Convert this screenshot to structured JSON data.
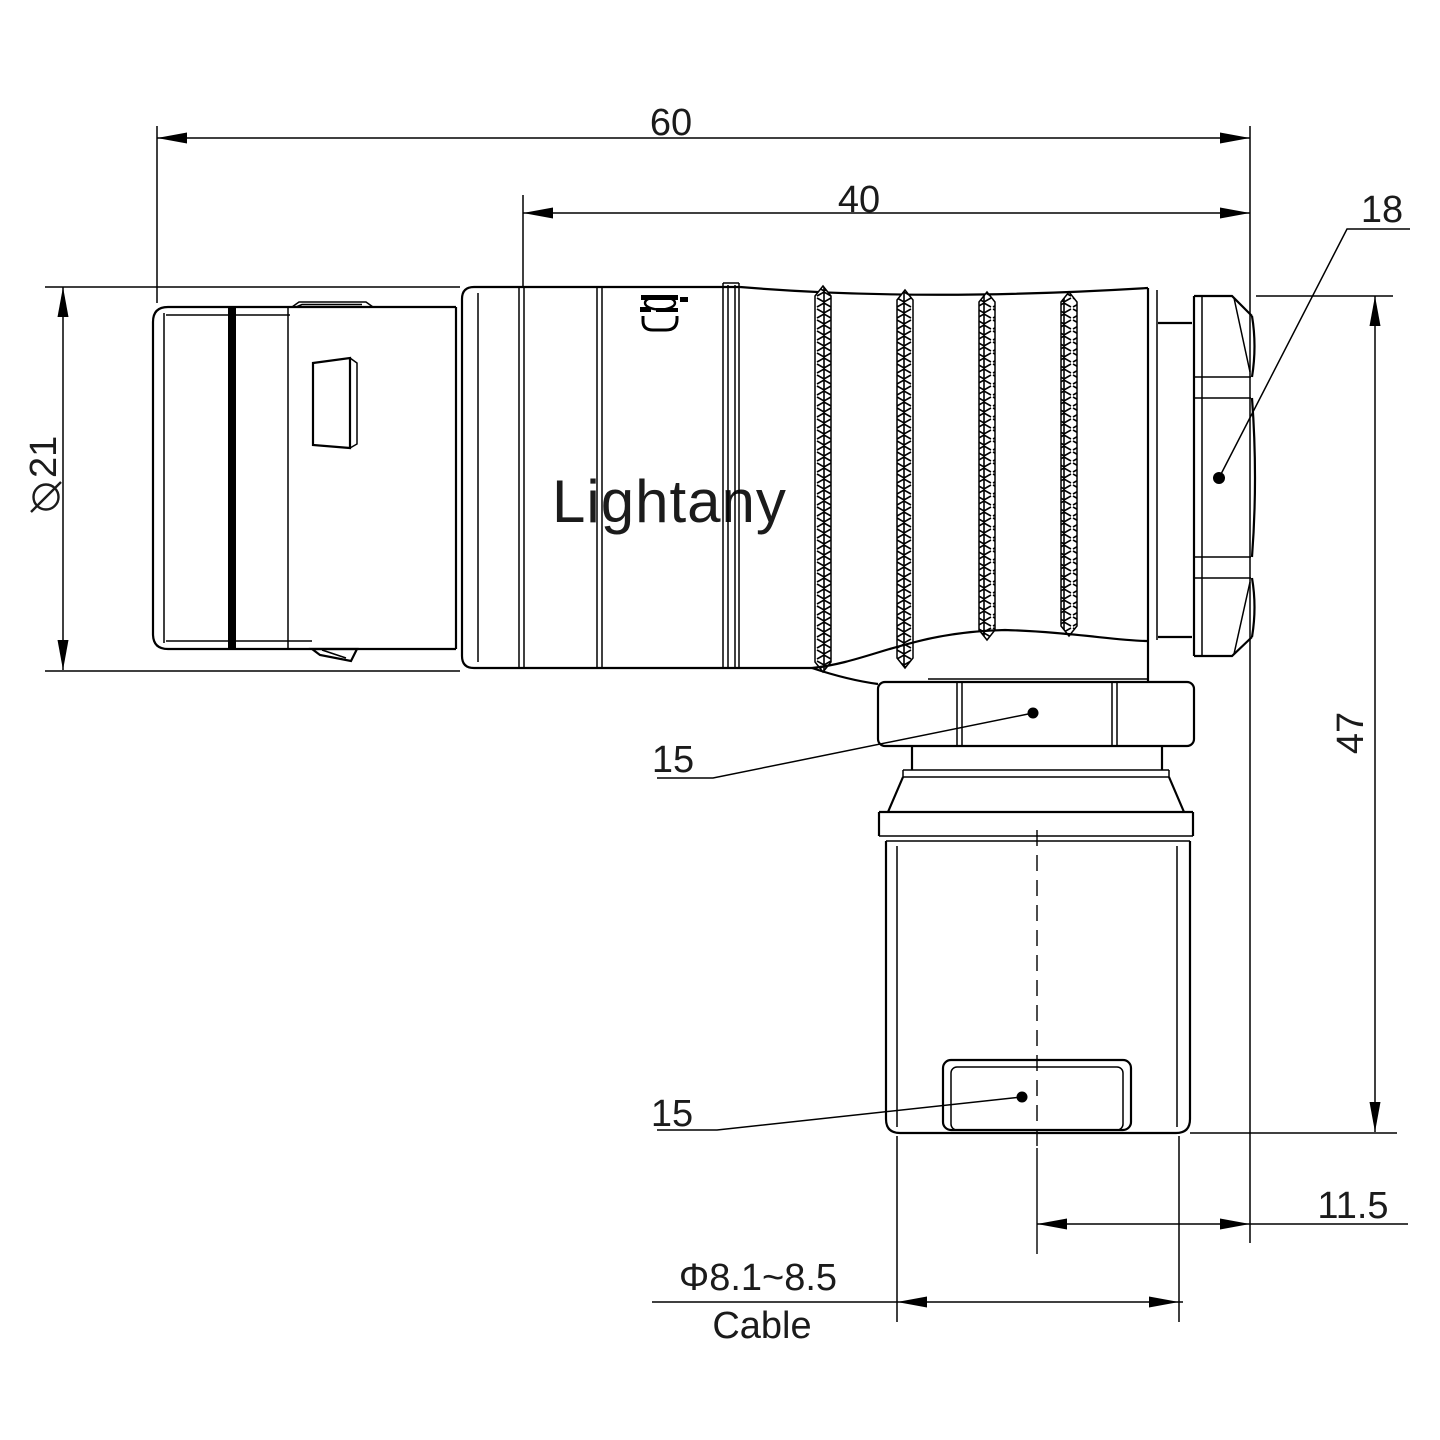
{
  "watermark": {
    "text": "Lightany",
    "color": "#f6ccd2"
  },
  "brand_mark": {
    "name": "lightany-logo-mark"
  },
  "colors": {
    "line": "#000000",
    "background": "#ffffff",
    "text": "#1b1b1b"
  },
  "dimensions": {
    "total_length": "60",
    "body_length": "40",
    "backnut_width": "18",
    "shell_diameter_symbol": "φ",
    "shell_diameter_value": "21",
    "height": "47",
    "coupling_nut": "15",
    "cable_clamp": "15",
    "axis_offset": "11.5",
    "cable_range": "Φ8.1~8.5",
    "cable_label": "Cable"
  }
}
